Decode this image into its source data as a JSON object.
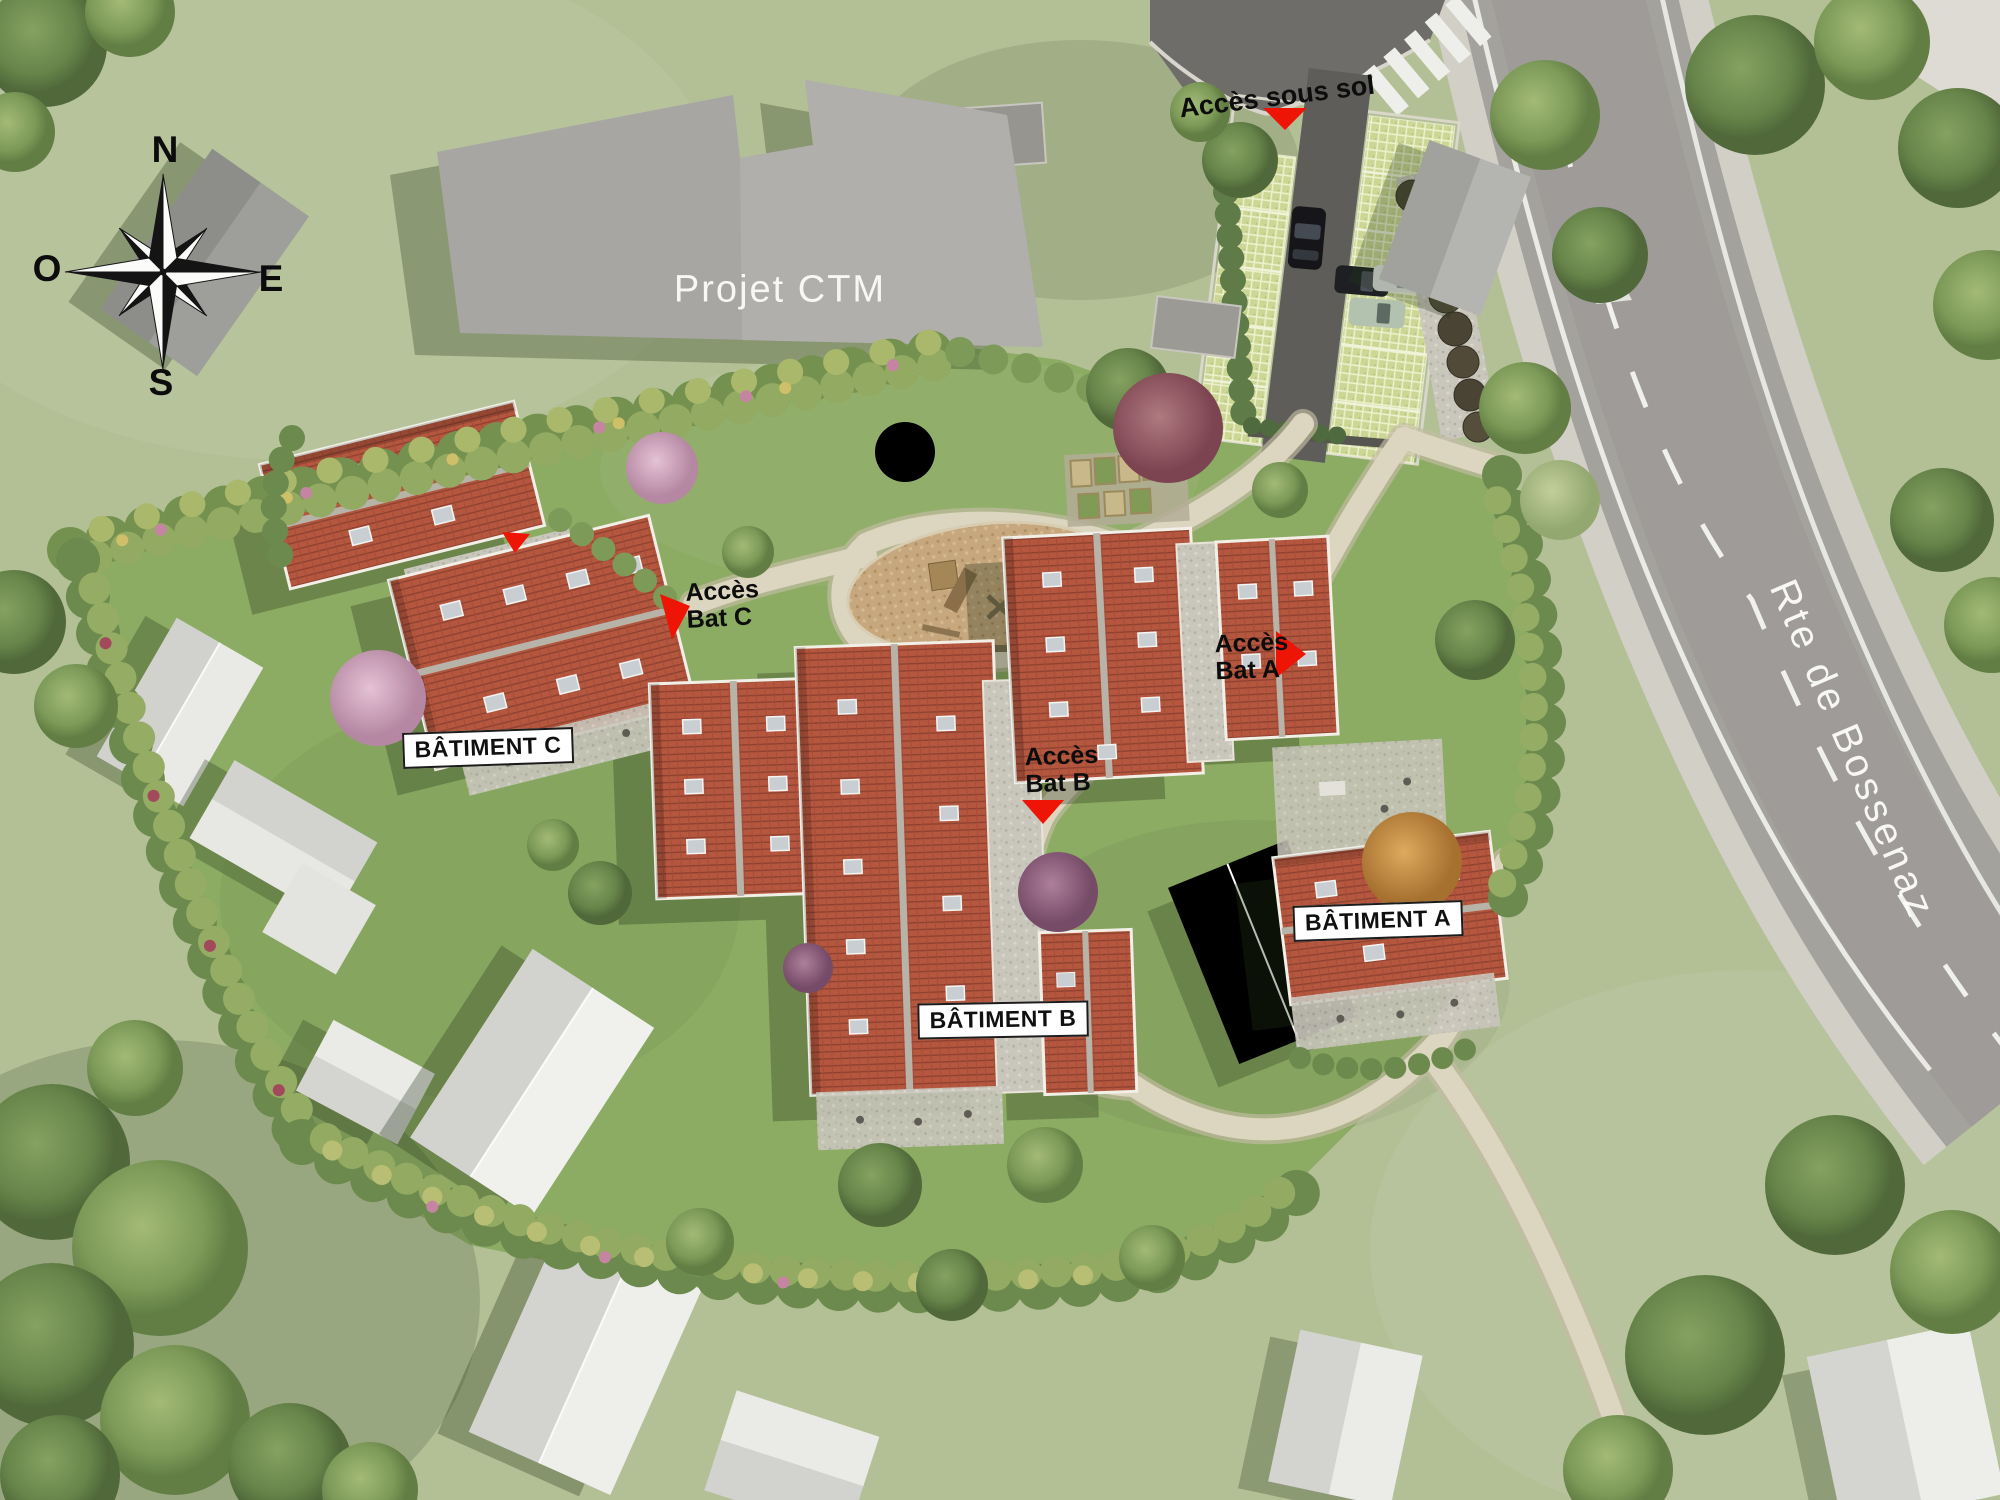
{
  "compass": {
    "north": "N",
    "south": "S",
    "east": "E",
    "west": "O"
  },
  "labels": {
    "projet_ctm": "Projet CTM",
    "acces_sous_sol": "Accès sous sol",
    "acces_bat_a": {
      "line1": "Accès",
      "line2": "Bat A"
    },
    "acces_bat_b": {
      "line1": "Accès",
      "line2": "Bat B"
    },
    "acces_bat_c": {
      "line1": "Accès",
      "line2": "Bat C"
    },
    "batiment_a": "BÂTIMENT A",
    "batiment_b": "BÂTIMENT B",
    "batiment_c": "BÂTIMENT C",
    "road_name": "Rte de Bossenaz"
  },
  "colors": {
    "marker_red": "#ee1507",
    "roof_terracotta": "#b5573f",
    "road_gray": "#a4a29d",
    "lawn_green": "#8cab63",
    "label_text": "#101010",
    "road_text": "#fcfcf9"
  }
}
